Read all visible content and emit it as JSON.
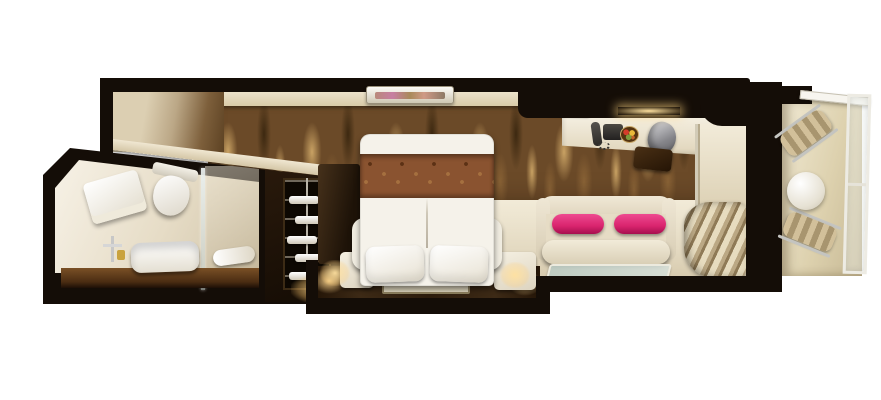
{
  "scene": {
    "type": "stateroom-floorplan-3d-render",
    "view": "top-down cutaway",
    "canvas": {
      "width": 881,
      "height": 400
    }
  },
  "rooms": [
    {
      "id": "entry-corridor",
      "label": "Entry corridor"
    },
    {
      "id": "bathroom",
      "label": "Bathroom"
    },
    {
      "id": "wardrobe",
      "label": "Wardrobe closet"
    },
    {
      "id": "bedroom",
      "label": "Bedroom"
    },
    {
      "id": "sitting-area",
      "label": "Sitting and desk area"
    },
    {
      "id": "balcony",
      "label": "Private balcony"
    }
  ],
  "furniture": {
    "wallpaper": "Bronze flame-pattern feature wall",
    "towel_stack": "Folded towels",
    "toilet": "Toilet",
    "sink": "Vanity trough sink",
    "faucet": "Chrome faucet",
    "shower_glass": "Glass shower partition",
    "shower": "Shower area",
    "shower_towel": "Bath towel",
    "wardrobe_shelves": "Open wardrobe shelving with linens",
    "bed": "Double bed with brown patterned runner",
    "pillow": "White pillow",
    "nightstand": "Bedside nightstand with lamp",
    "rug": "Bedside runner rug",
    "platform": "Dark wood bed platform",
    "tv": "Flat-screen TV on ledge",
    "sofa": "Cream two-seat sofa",
    "bolster": "Magenta bolster cushion",
    "coffee_table": "Glass coffee table",
    "desk": "Vanity desk",
    "telephone": "Telephone",
    "fruit_bowl": "Fruit bowl",
    "desk_chair": "Chrome desk chair",
    "ottoman": "Dark ottoman stool",
    "overhead_cabinet": "Overhead cabinet with light",
    "mirror_panel": "Mirror panel by balcony door",
    "curtains": "Striped curtains",
    "balcony_floor": "Balcony deck",
    "balcony_door": "Open balcony door",
    "lounge_chair": "Balcony sling chair",
    "balcony_table": "Round balcony table",
    "railing": "Glass balcony railing"
  },
  "wardrobe": {
    "shelf_count": 5
  },
  "colors": {
    "wall": "#140d07",
    "wallpaper-base": "#6b4a28",
    "wallpaper-light": "#c9a264",
    "wallpaper-mid": "#8a6336",
    "wallpaper-dark": "#3c2810",
    "bed-white": "#f5f2ea",
    "runner": "#8a5330",
    "pink": "#d9246e",
    "pink-light": "#ee4a90",
    "floor-cream": "#efe7d3",
    "floor-dark": "#2e1d0e",
    "balcony-floor": "#e2d7ba",
    "glow": "#ffd98f"
  }
}
